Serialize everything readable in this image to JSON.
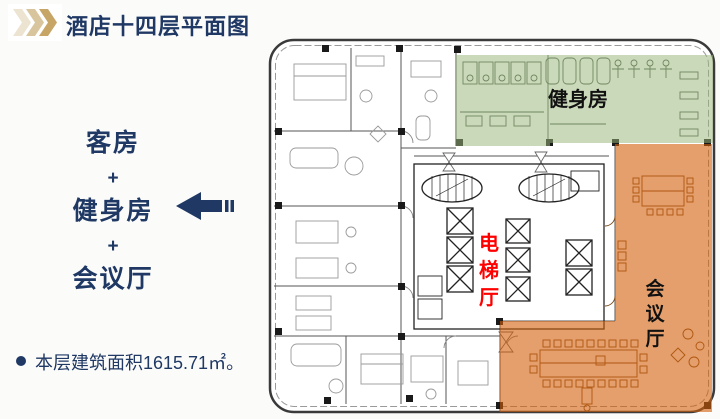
{
  "slide": {
    "title": "酒店十四层平面图",
    "summary_lines": [
      "客房",
      "+",
      "健身房",
      "+",
      "会议厅"
    ],
    "footnote": "本层建筑面积1615.71㎡。"
  },
  "floorplan": {
    "gym_label": "健身房",
    "elevator_label": "电梯厅",
    "elevator_chars": [
      "电",
      "梯",
      "厅"
    ],
    "conference_label": "会议厅",
    "conference_chars": [
      "会",
      "议",
      "厅"
    ],
    "colors": {
      "navy": "#1f3864",
      "chevron_light": "#ece3d0",
      "chevron_mid": "#d9c59d",
      "chevron_dark": "#c7a567",
      "gym_fill": "#9ab77a",
      "conference_fill": "#d25f0a",
      "elevator_text": "#ff0000",
      "label_black": "#111111"
    }
  }
}
